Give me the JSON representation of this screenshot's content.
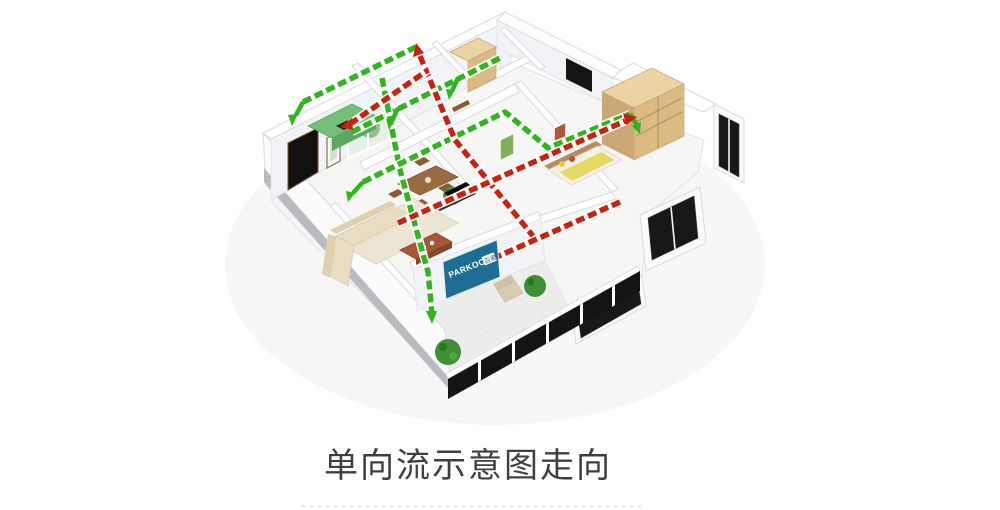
{
  "illustration": {
    "caption": "单向流示意图走向",
    "banner": {
      "brand": "PARKOO",
      "brand_suffix": "百奥"
    },
    "colors": {
      "supply": "#2fb51e",
      "exhaust": "#c92310",
      "banner": "#1e6e94",
      "caption": "#3f3f3f"
    }
  }
}
